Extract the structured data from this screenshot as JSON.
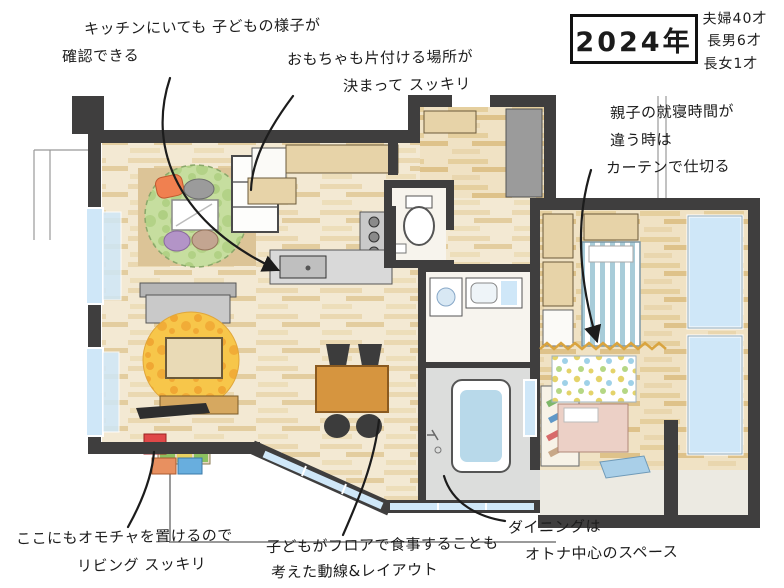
{
  "year": "2024年",
  "family": [
    "夫婦40才",
    "長男6才",
    "長女1才"
  ],
  "notes": {
    "kitchen_view": [
      "キッチンにいても 子どもの様子が",
      "確認できる"
    ],
    "toy_place": [
      "おもちゃも片付ける場所が",
      "決まって スッキリ"
    ],
    "curtain": [
      "親子の就寝時間が",
      "違う時は",
      "カーテンで仕切る"
    ],
    "living_toys": [
      "ここにもオモチャを置けるので",
      "リビング スッキリ"
    ],
    "floor_dining": [
      "子どもがフロアで食事することも",
      "考えた動線&レイアウト"
    ],
    "dining_adult": [
      "ダイニングは",
      "オトナ中心のスペース"
    ]
  },
  "colors": {
    "wall": "#3f3e3e",
    "ink": "#1c1c1c",
    "wood_floor": "#f3e9d3",
    "window_blue": "#cfe7f8",
    "kids_rug_green": "#c6de9f",
    "living_rug_yellow": "#f7c64a",
    "dining_table_wood": "#d6953f",
    "curtain_zigzag": "#d9a43f",
    "bed_stripe_blue": "#a8ccd9",
    "baby_bed_pink": "#ecd0c6"
  }
}
